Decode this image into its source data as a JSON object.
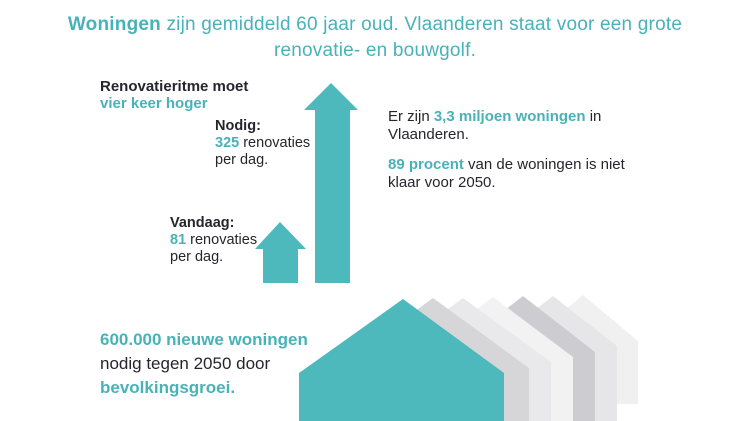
{
  "colors": {
    "accent_shape": "#4db9bd",
    "accent_text": "#48b2b9",
    "dark_text": "#26252e",
    "house_grays": [
      "#d6d6d9",
      "#e9e9eb",
      "#f2f2f3",
      "#cdcdd1",
      "#e6e6e8",
      "#f0f0f1"
    ]
  },
  "title": {
    "highlight": "Woningen",
    "line1_rest": " zijn gemiddeld 60 jaar oud. Vlaanderen staat voor een grote",
    "line2": "renovatie- en bouwgolf."
  },
  "renovation_pace": {
    "heading_dark": "Renovatieritme moet",
    "heading_accent": "vier keer hoger",
    "needed": {
      "label": "Nodig:",
      "value": "325",
      "rest": " renovaties",
      "line2": "per dag."
    },
    "today": {
      "label": "Vandaag:",
      "value": "81",
      "rest": " renovaties",
      "line2": "per dag."
    }
  },
  "housing_stock": {
    "p1_pre": "Er zijn ",
    "p1_accent": "3,3 miljoen woningen",
    "p1_post": " in",
    "p1_line2": "Vlaanderen.",
    "p2_accent": "89 procent",
    "p2_post": " van de woningen is niet",
    "p2_line2": "klaar voor 2050."
  },
  "new_homes": {
    "line1_accent": "600.000 nieuwe woningen",
    "line2": "nodig tegen 2050 door",
    "line3_accent": "bevolkingsgroei."
  }
}
